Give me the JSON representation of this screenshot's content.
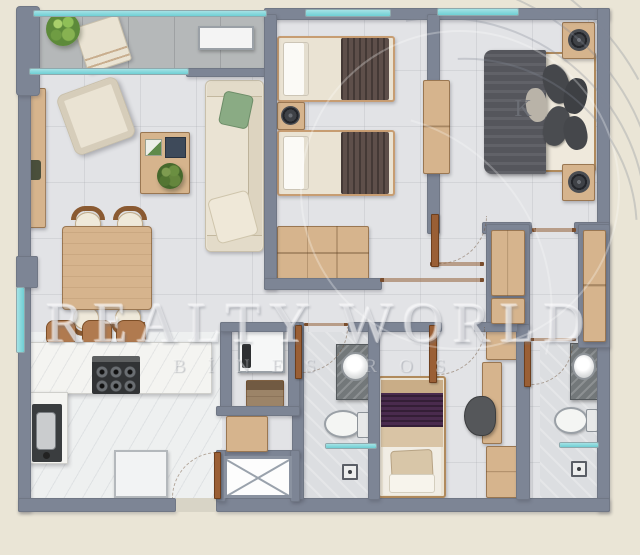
{
  "watermark": {
    "brand": "REALTY WORLD",
    "subtitle": "BİNES ROS"
  },
  "labels": {
    "king_bed": "K"
  },
  "colors": {
    "background": "#eae5d6",
    "wall": "#7d8595",
    "floor": "#e2e3e6",
    "floor_kitchen": "#eef0f0",
    "balcony_floor": "#b5b8b9",
    "glass": "#6fcfd4",
    "wood_light": "#d6b48d",
    "wood_mid": "#c39b70",
    "wood_dark": "#8c5f3b",
    "fabric_cream": "#eae3d3",
    "blanket_twin": "#5e4f4a",
    "duvet_king": "#55565c",
    "blanket_purple": "#4a2b4e",
    "plant_green": "#5d8a3a",
    "marble_dark": "#73787a",
    "appliance_dark": "#313335",
    "door_wood": "#9a5f35"
  }
}
